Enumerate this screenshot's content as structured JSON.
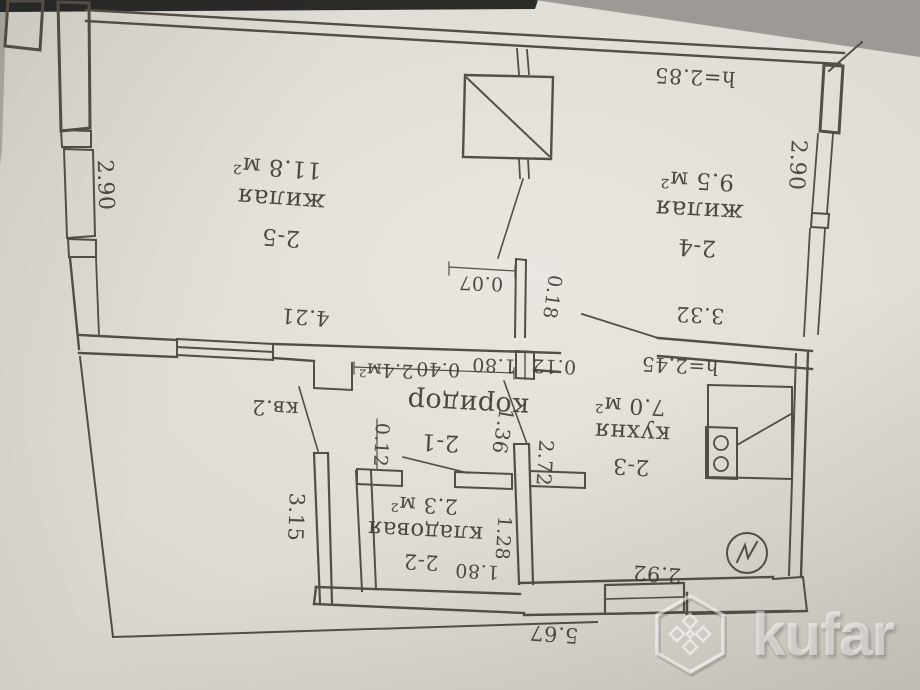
{
  "watermark": {
    "label": "kufar"
  },
  "plan": {
    "apartment_label": "кв.2",
    "rooms": [
      {
        "number": "2-5",
        "type": "жилая",
        "area": "11.8 м²"
      },
      {
        "number": "2-4",
        "type": "жилая",
        "area": "9.5 м²"
      },
      {
        "number": "2-1",
        "type": "коридор",
        "area": "2.4м²"
      },
      {
        "number": "2-2",
        "type": "кладовая",
        "area": "2.3 м²"
      },
      {
        "number": "2-3",
        "type": "кухня",
        "area": "7.0 м²"
      }
    ],
    "heights": {
      "main": "h=2.85",
      "lower": "h=2.45"
    },
    "dimensions": {
      "left_wall": "2.90",
      "right_wall": "2.90",
      "room25_wall": "4.21",
      "kitchen_wall": "3.32",
      "stub_width": "0.07",
      "stub_depth": "0.18",
      "niche": "0.40",
      "hall_opening": "1.80",
      "stub2": "0.12",
      "partition": "0.12",
      "corridor_kitchen": "1.36",
      "kitchen_wall_inner": "2.72",
      "lower_left_wall": "3.15",
      "storage_wall": "1.28",
      "storage_opening": "1.80",
      "kitchen_bottom": "2.92",
      "yard": "5.67"
    }
  }
}
